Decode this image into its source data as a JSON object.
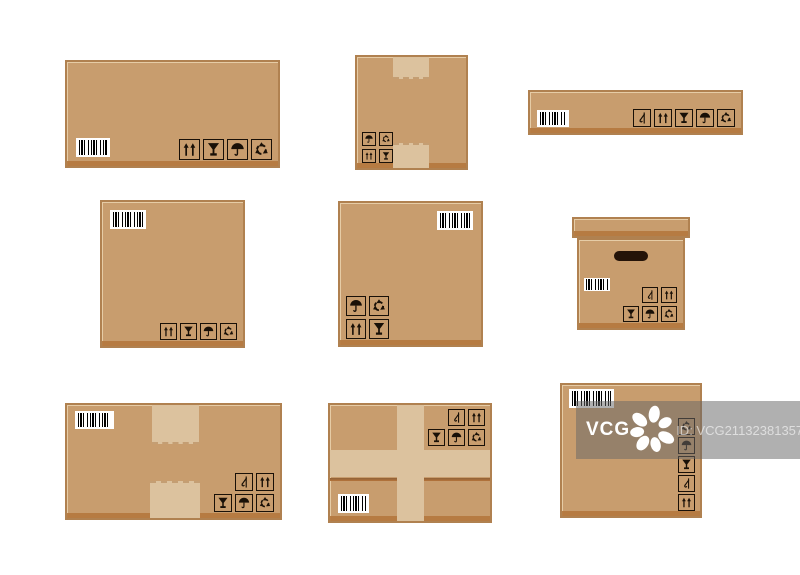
{
  "image_label": "flat cardboard boxes illustration set",
  "colors": {
    "background": "#ffffff",
    "box_fill": "#c89d6e",
    "box_border": "#b08150",
    "box_bottom_shade": "#b5793f",
    "tape": "#dcc29e",
    "icon": "#191007",
    "barcode_bg": "#ffffff",
    "barcode_bars": "#000000",
    "watermark_bar": "#696969",
    "watermark_text": "#ffffff"
  },
  "icon_legend": {
    "up": "this-way-up",
    "glass": "fragile",
    "umbrella": "keep-dry",
    "recycle": "recycle",
    "hook": "no-hooks"
  },
  "watermark": {
    "logo_text": "VCG",
    "id_text": "ID: VCG211323813579"
  },
  "boxes": [
    {
      "css": "box-1",
      "name": "wide-closed-box",
      "kind": "flat",
      "tape": null,
      "barcode": "bottom-left",
      "icons": {
        "layout": "rows-bottom-right",
        "rows": [
          [
            "up",
            "glass",
            "umbrella",
            "recycle"
          ]
        ]
      }
    },
    {
      "css": "box-2",
      "name": "square-taped-box",
      "kind": "flat",
      "tape": "ends",
      "barcode": null,
      "icons": {
        "layout": "rows-bottom-left",
        "rows": [
          [
            "umbrella",
            "recycle"
          ],
          [
            "up",
            "glass"
          ]
        ]
      }
    },
    {
      "css": "box-3",
      "name": "long-flat-box",
      "kind": "flat",
      "tape": null,
      "barcode": "left-bottom",
      "icons": {
        "layout": "rows-bottom-right",
        "rows": [
          [
            "hook",
            "up",
            "glass",
            "umbrella",
            "recycle"
          ]
        ]
      }
    },
    {
      "css": "box-4",
      "name": "square-box",
      "kind": "flat",
      "tape": null,
      "barcode": "top-left",
      "icons": {
        "layout": "rows-bottom-right",
        "rows": [
          [
            "up",
            "glass",
            "umbrella",
            "recycle"
          ]
        ]
      }
    },
    {
      "css": "box-5",
      "name": "square-box",
      "kind": "flat",
      "tape": null,
      "barcode": "top-right",
      "icons": {
        "layout": "rows-bottom-left",
        "rows": [
          [
            "umbrella",
            "recycle"
          ],
          [
            "up",
            "glass"
          ]
        ]
      }
    },
    {
      "css": "box-6",
      "name": "lid-box-with-handle",
      "kind": "lid",
      "tape": null,
      "barcode": "left-middle",
      "icons": {
        "layout": "rows-bottom-right",
        "rows": [
          [
            "hook",
            "up"
          ],
          [
            "glass",
            "umbrella",
            "recycle"
          ]
        ]
      }
    },
    {
      "css": "box-7",
      "name": "wide-taped-box",
      "kind": "flat",
      "tape": "ends",
      "barcode": "top-left",
      "icons": {
        "layout": "rows-bottom-right",
        "rows": [
          [
            "hook",
            "up"
          ],
          [
            "glass",
            "umbrella",
            "recycle"
          ]
        ]
      }
    },
    {
      "css": "box-8",
      "name": "cross-taped-box",
      "kind": "flat",
      "tape": "cross",
      "barcode": "bottom-left",
      "icons": {
        "layout": "rows-top-right",
        "rows": [
          [
            "hook",
            "up"
          ],
          [
            "glass",
            "umbrella",
            "recycle"
          ]
        ]
      }
    },
    {
      "css": "box-9",
      "name": "tall-box",
      "kind": "flat",
      "tape": null,
      "barcode": "top-left",
      "icons": {
        "layout": "col-right",
        "rows": [
          [
            "recycle"
          ],
          [
            "umbrella"
          ],
          [
            "glass"
          ],
          [
            "hook"
          ],
          [
            "up"
          ]
        ]
      }
    }
  ]
}
